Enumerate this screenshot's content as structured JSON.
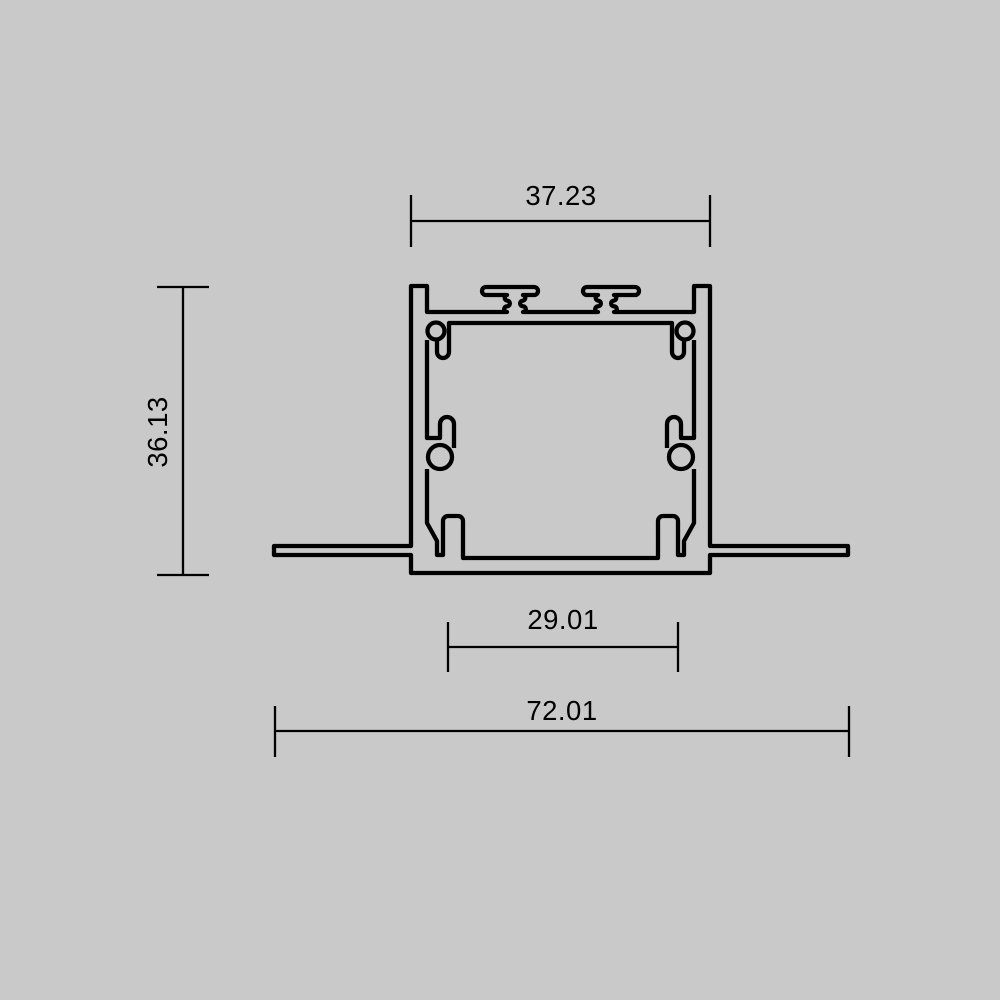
{
  "drawing": {
    "type": "technical-dimension-drawing",
    "subject": "recessed-aluminum-profile-cross-section",
    "colors": {
      "background": "#c9c9c9",
      "line": "#000000"
    },
    "dimensions": {
      "top_width": {
        "value": "37.23",
        "orientation": "horizontal",
        "measures": "profile body width"
      },
      "height": {
        "value": "36.13",
        "orientation": "vertical",
        "measures": "profile overall height"
      },
      "inner_width": {
        "value": "29.01",
        "orientation": "horizontal",
        "measures": "inner bottom opening width"
      },
      "overall_width": {
        "value": "72.01",
        "orientation": "horizontal",
        "measures": "overall width including flanges"
      }
    }
  }
}
